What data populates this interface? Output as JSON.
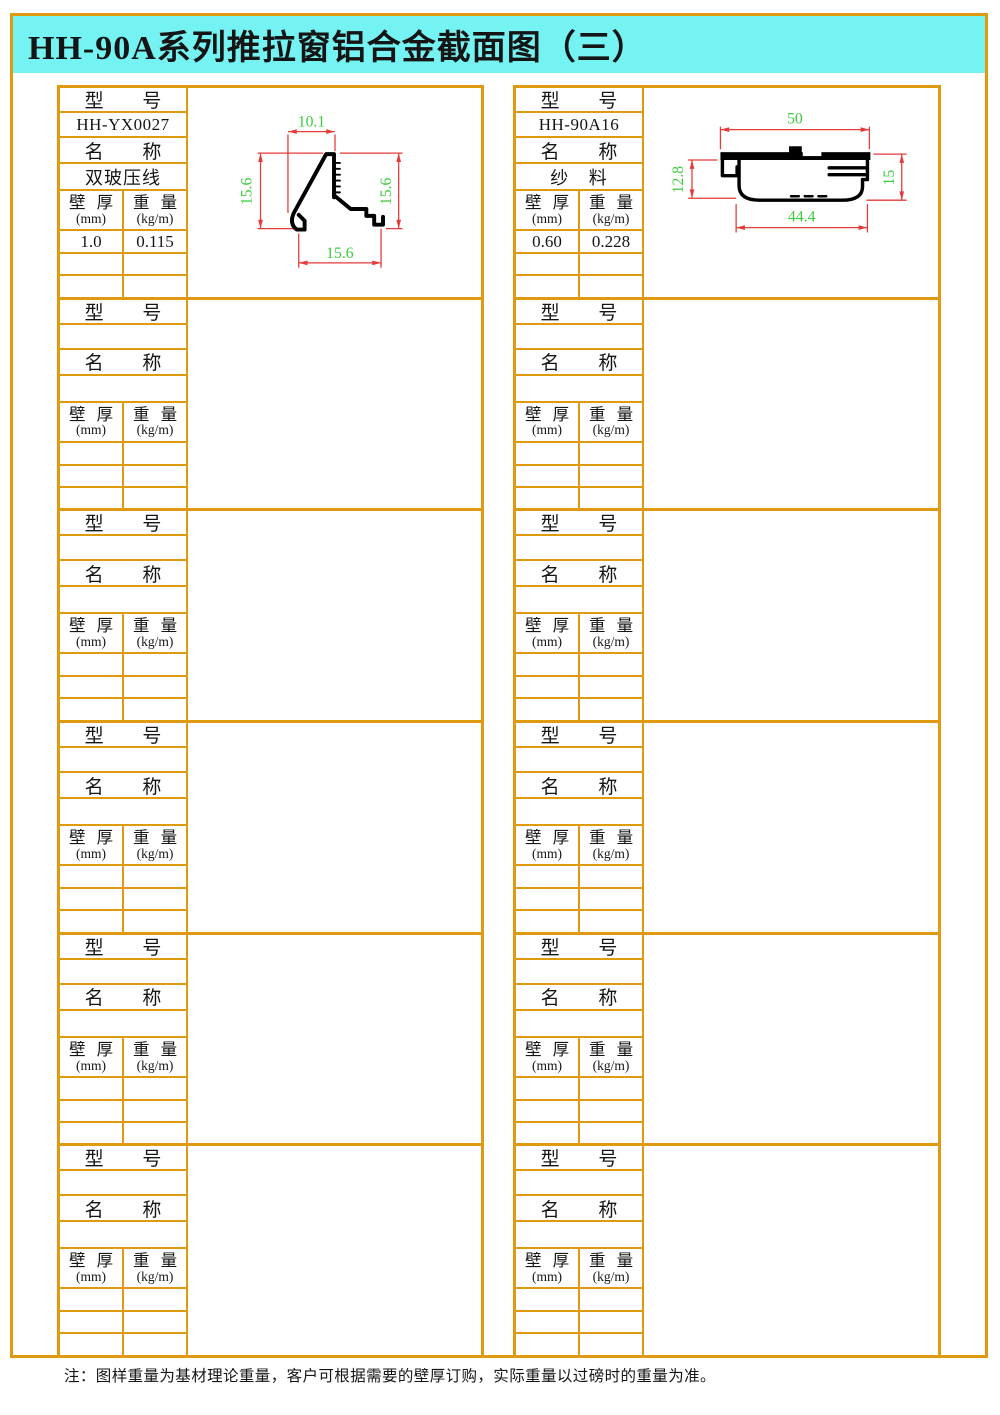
{
  "title": "HH-90A系列推拉窗铝合金截面图（三）",
  "labels": {
    "model": "型 号",
    "name": "名 称",
    "wall": "壁 厚",
    "wall_unit": "(mm)",
    "weight": "重 量",
    "weight_unit": "(kg/m)"
  },
  "columns": {
    "left": {
      "filled_block": {
        "model": "HH-YX0027",
        "name": "双玻压线",
        "rows": [
          {
            "wall": "1.0",
            "weight": "0.115"
          }
        ],
        "dims": {
          "top": "10.1",
          "left": "15.6",
          "right": "15.6",
          "bottom": "15.6"
        }
      },
      "empty_blocks": 5
    },
    "right": {
      "filled_block": {
        "model": "HH-90A16",
        "name": "纱 料",
        "rows": [
          {
            "wall": "0.60",
            "weight": "0.228"
          }
        ],
        "dims": {
          "top": "50",
          "left": "12.8",
          "right": "15",
          "bottom": "44.4"
        }
      },
      "empty_blocks": 5
    }
  },
  "note": "注：图样重量为基材理论重量，客户可根据需要的壁厚订购，实际重量以过磅时的重量为准。",
  "colors": {
    "table_border": "#e09a10",
    "title_background": "#75f2f2",
    "dimension_lines": "#e43b3b",
    "dimension_text": "#3bcc3b"
  }
}
